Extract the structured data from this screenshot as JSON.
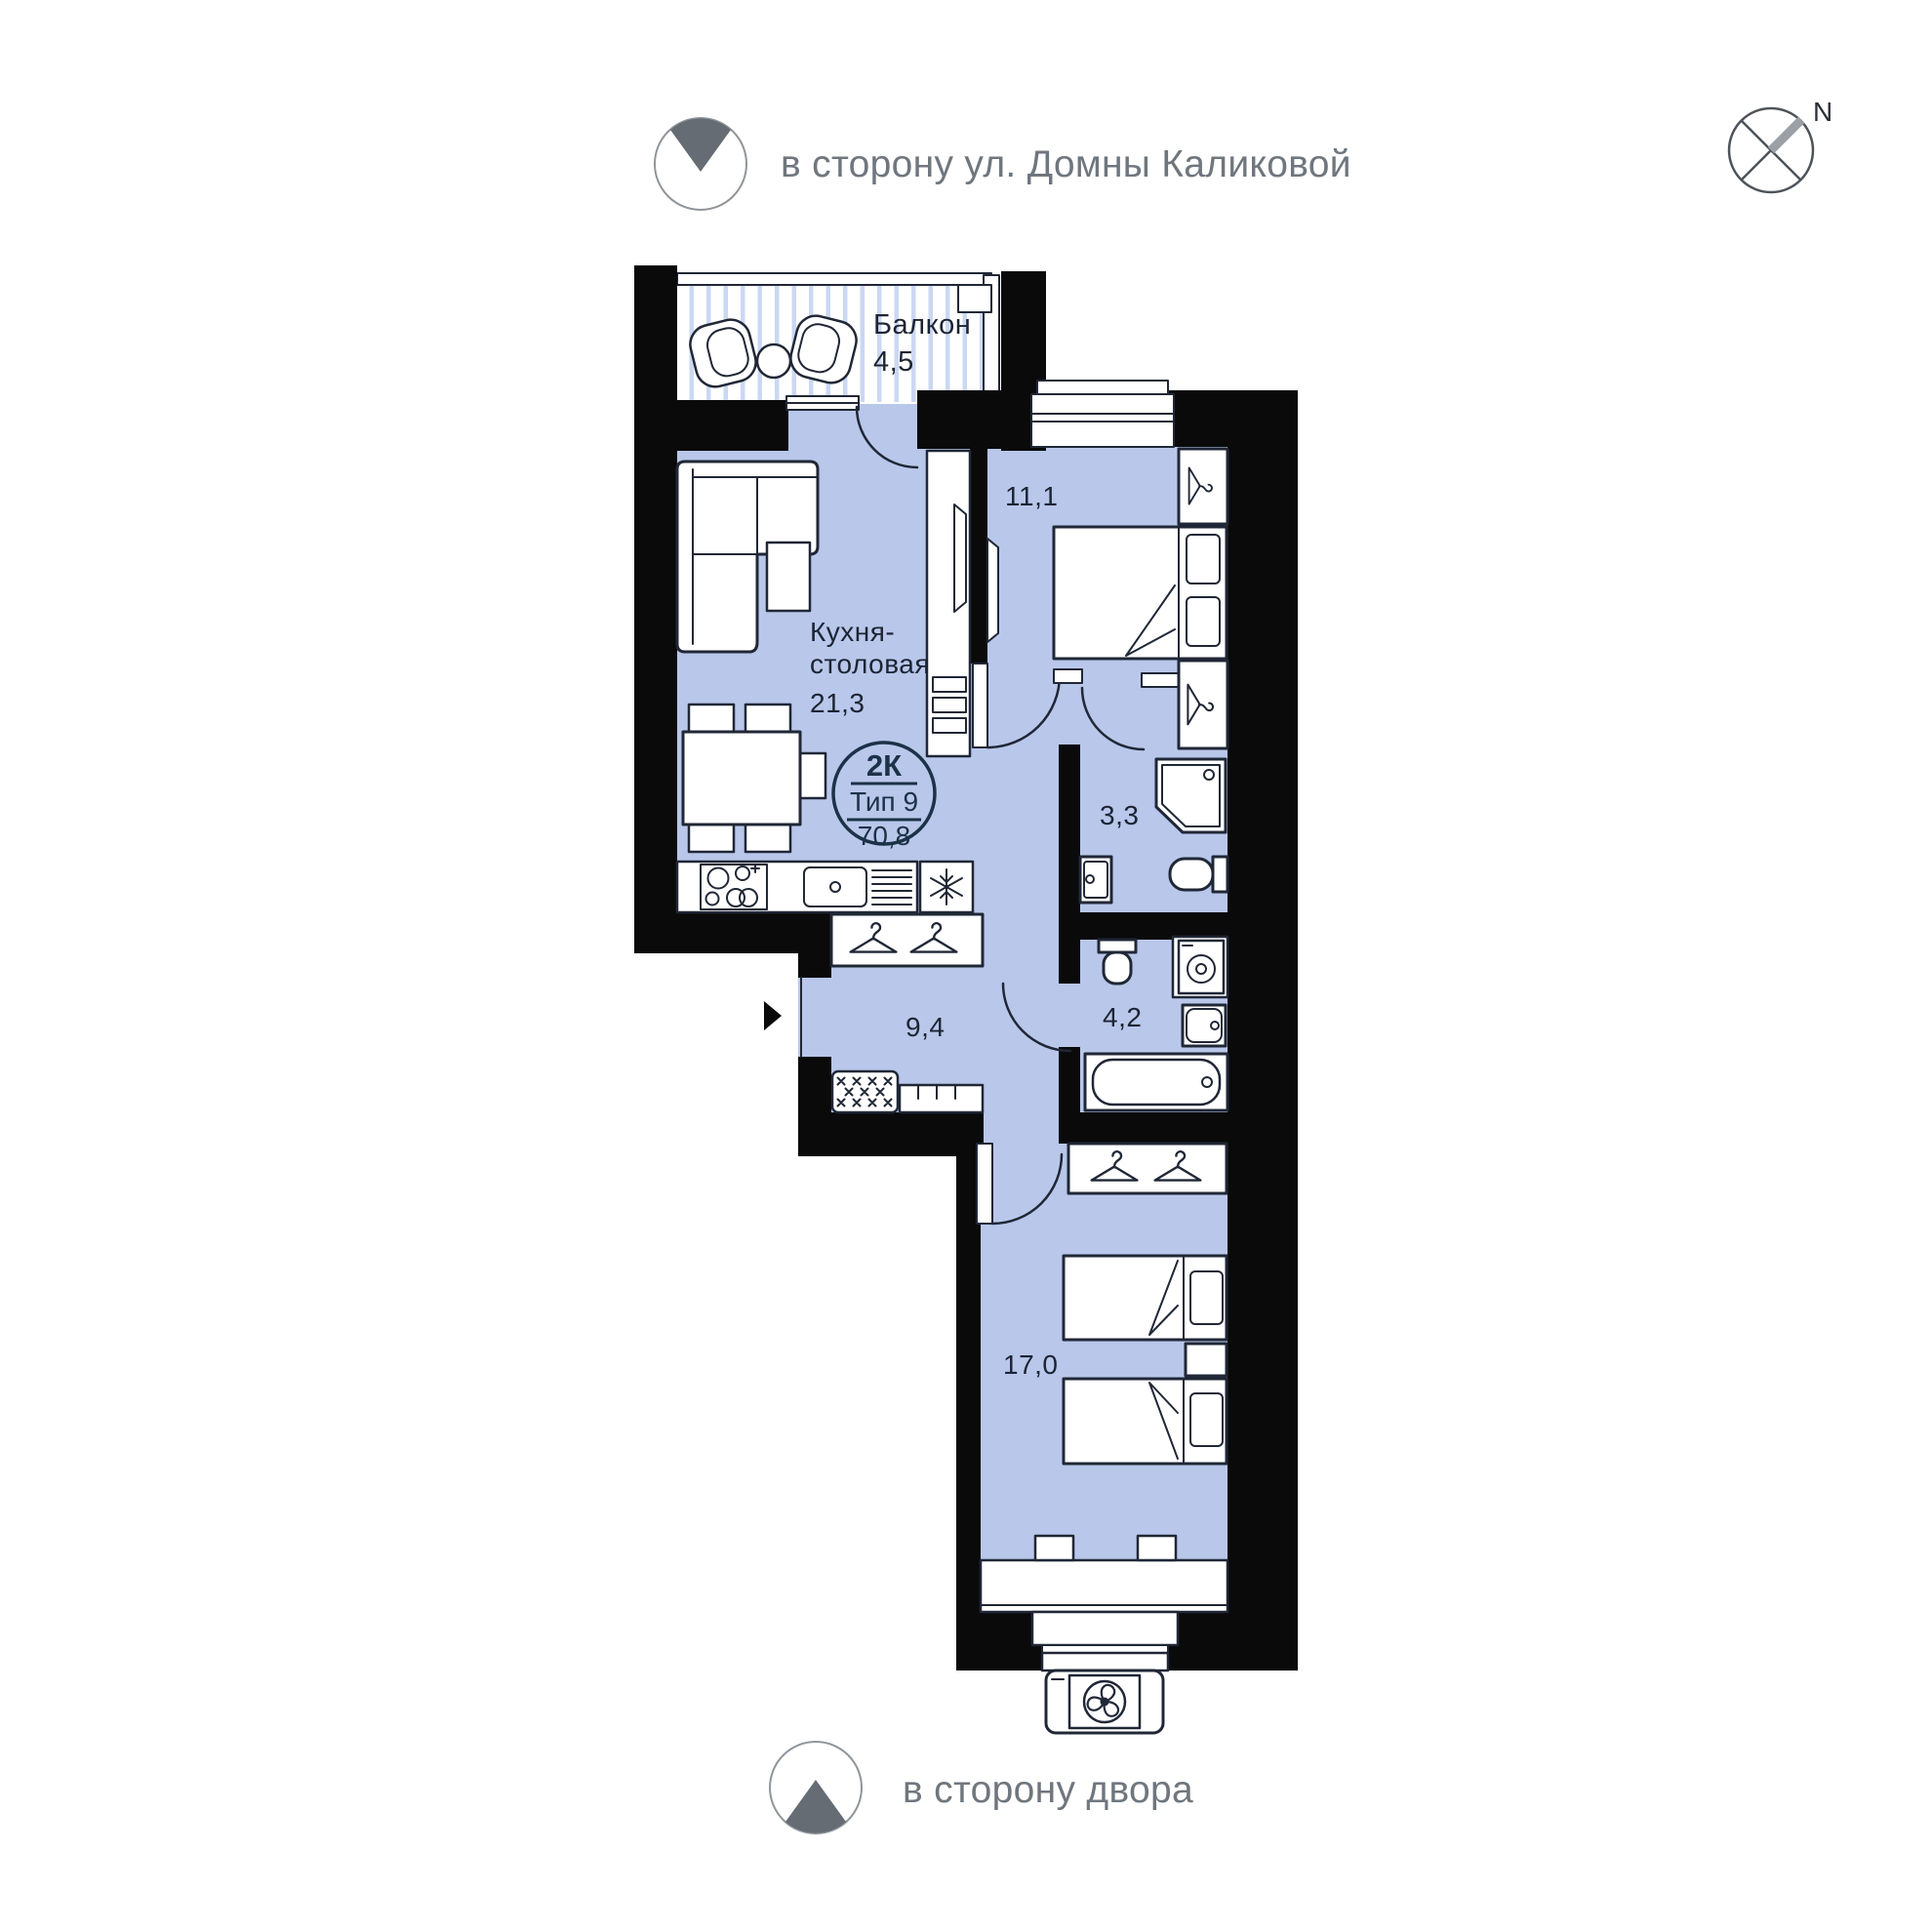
{
  "directions": {
    "street": "в сторону ул. Домны Каликовой",
    "yard": "в сторону двора",
    "north": "N"
  },
  "unit_badge": {
    "rooms": "2К",
    "type": "Тип 9",
    "area": "70,8"
  },
  "rooms": {
    "balcony": {
      "name": "Балкон",
      "area": "4,5"
    },
    "kitchen_dining": {
      "name": "Кухня-столовая",
      "name_line1": "Кухня-",
      "name_line2": "столовая",
      "area": "21,3"
    },
    "bedroom_1": {
      "area": "11,1"
    },
    "shower_room": {
      "area": "3,3"
    },
    "hallway": {
      "area": "9,4"
    },
    "bathroom": {
      "area": "4,2"
    },
    "bedroom_2": {
      "area": "17,0"
    }
  },
  "colors": {
    "floor": "#b8c7ea",
    "wall": "#0a0a0b",
    "line": "#202736",
    "text": "#1c2433",
    "gray": "#6f767e",
    "grayicon": "#656c74",
    "compass": "#4d5359",
    "ray": "#9aa0a6",
    "badge": "#1c3247",
    "stripe": "#cbd8f2"
  }
}
